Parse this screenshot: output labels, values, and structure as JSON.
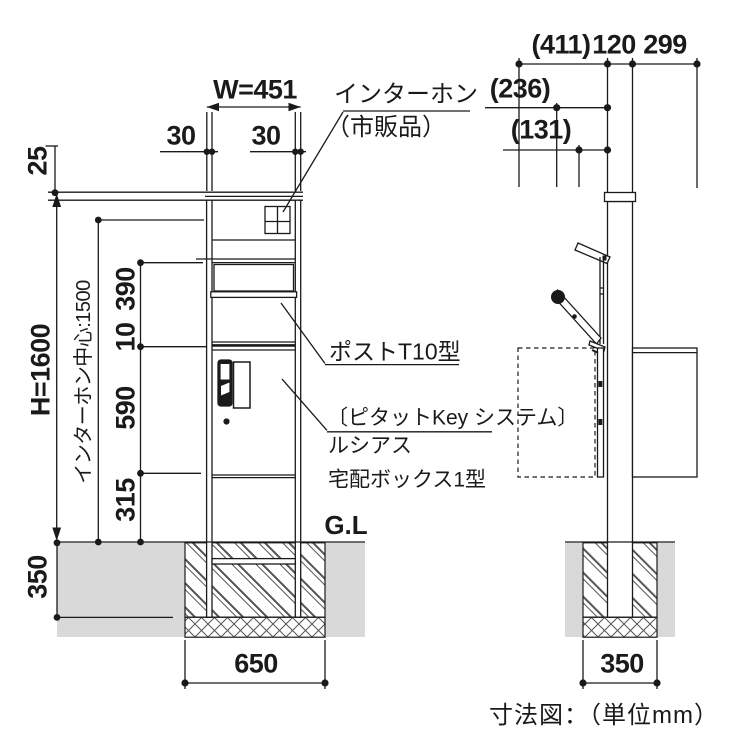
{
  "caption": "寸法図：（単位mm）",
  "front": {
    "dims": {
      "cap_offset": "25",
      "overall_width": "W=451",
      "post_width_left": "30",
      "post_width_right": "30",
      "overall_height": "H=1600",
      "intercom_center_height": "インターホン中心:1500",
      "post_section": "390",
      "gap": "10",
      "box_section": "590",
      "leg_section": "315",
      "foundation_depth": "350",
      "foundation_width": "650"
    },
    "annotations": {
      "intercom": "インターホン",
      "intercom_note": "（市販品）",
      "post_model": "ポストT10型",
      "key_system": "〔ピタットKey システム〕",
      "series": "ルシアス",
      "box_model": "宅配ボックス1型",
      "ground_level": "G.L"
    }
  },
  "side": {
    "dims": {
      "flap_open_reach": "(411)",
      "post_depth": "120",
      "box_depth": "299",
      "flap_mid_reach": "(236)",
      "flap_low_reach": "(131)",
      "foundation_width": "350"
    }
  },
  "colors": {
    "line": "#1a1a1a",
    "ground": "#d9d9d9",
    "hatch": "#555555"
  }
}
